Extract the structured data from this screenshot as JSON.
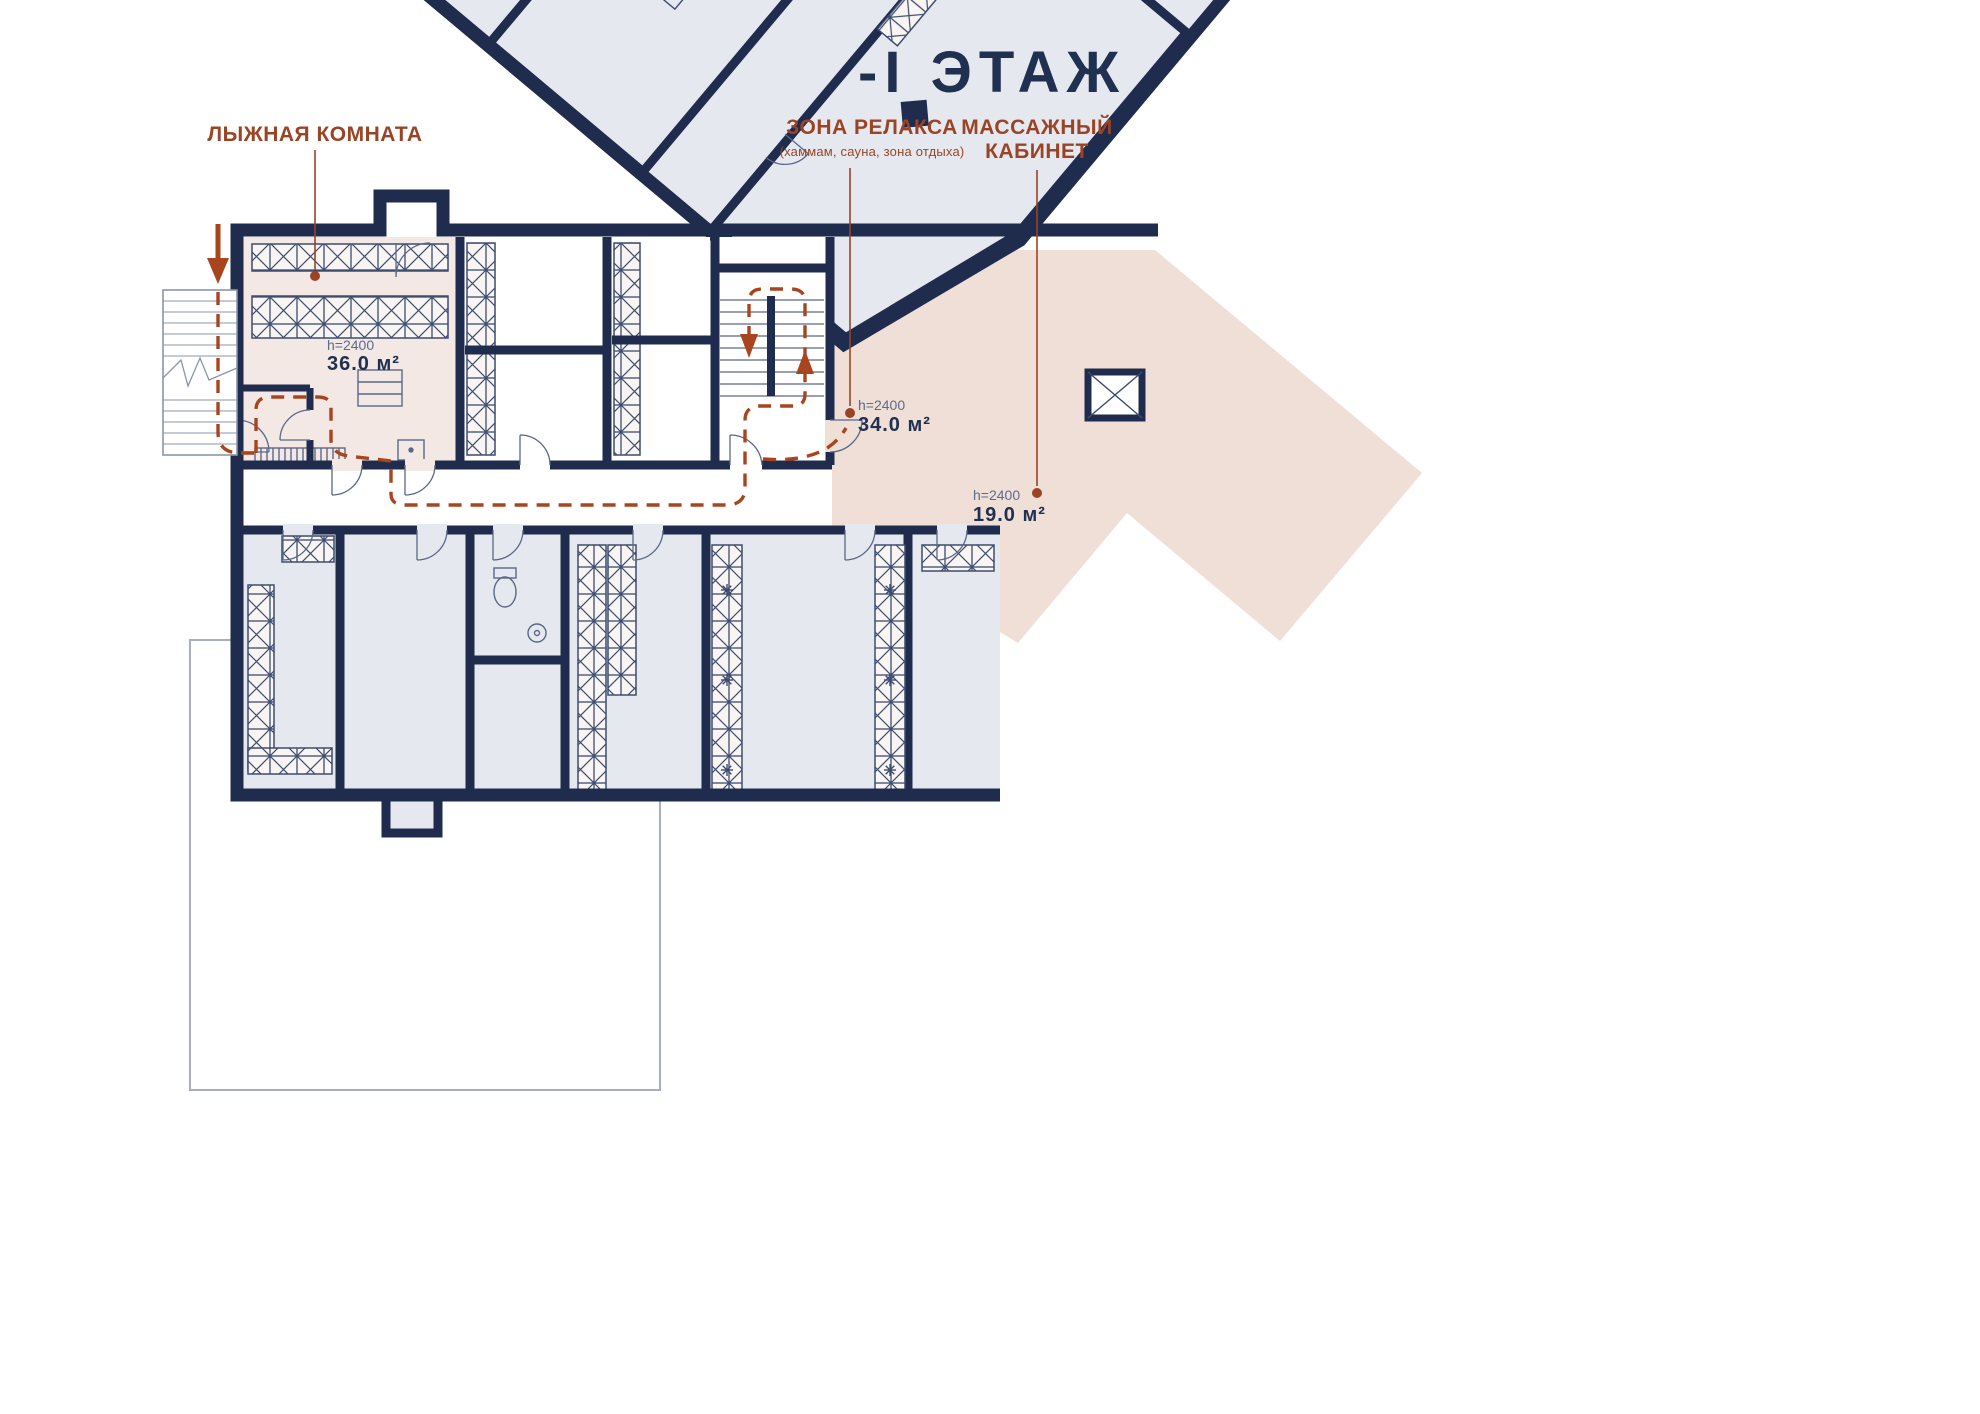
{
  "title": "-I ЭТАЖ",
  "annotations": {
    "ski_room": {
      "label": "ЛЫЖНАЯ КОМНАТА",
      "height_label": "h=2400",
      "area": "36.0 м²"
    },
    "relax_zone": {
      "label": "ЗОНА РЕЛАКСА",
      "sublabel": "(хаммам, сауна, зона отдыха)",
      "height_label": "h=2400",
      "area": "34.0 м²"
    },
    "massage_room": {
      "label_line1": "МАССАЖНЫЙ",
      "label_line2": "КАБИНЕТ",
      "height_label": "h=2400",
      "area": "19.0 м²"
    }
  },
  "fixtures": {
    "dishwasher_label": "DW"
  },
  "colors": {
    "wall_navy": "#1f2c4e",
    "title_navy": "#203050",
    "annotation_red": "#9a4425",
    "route_red": "#a8451f",
    "room_gray": "#e5e8ef",
    "ski_pink": "#f3e8e3",
    "relax_pink": "#efdfd7",
    "sauna_pink": "#e9d3c9",
    "height_gray_blue": "#5c6b8d"
  }
}
